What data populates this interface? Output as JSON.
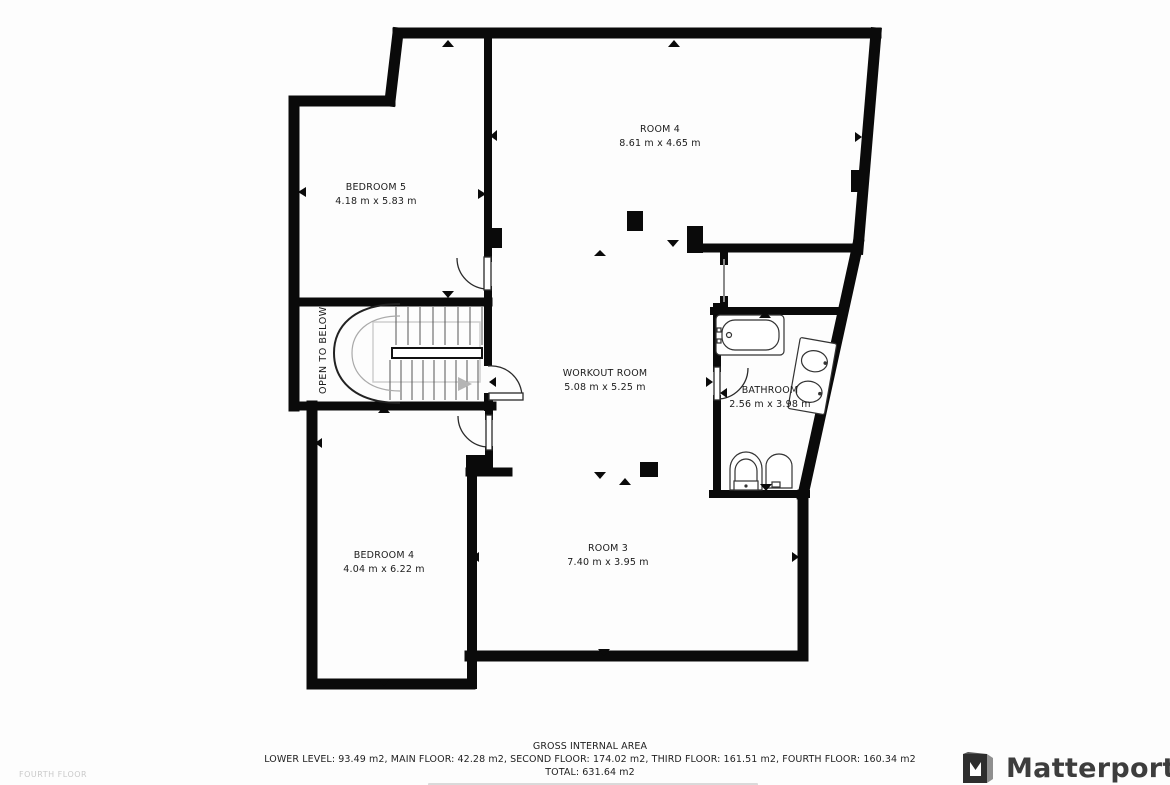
{
  "floor_label": "FOURTH FLOOR",
  "rooms": [
    {
      "id": "bedroom-5",
      "name": "BEDROOM 5",
      "dims": "4.18 m x 5.83 m"
    },
    {
      "id": "room-4",
      "name": "ROOM 4",
      "dims": "8.61 m x 4.65 m"
    },
    {
      "id": "workout-room",
      "name": "WORKOUT ROOM",
      "dims": "5.08 m x 5.25 m"
    },
    {
      "id": "bathroom",
      "name": "BATHROOM",
      "dims": "2.56 m x 3.98 m"
    },
    {
      "id": "bedroom-4",
      "name": "BEDROOM 4",
      "dims": "4.04 m x 6.22 m"
    },
    {
      "id": "room-3",
      "name": "ROOM 3",
      "dims": "7.40 m x 3.95 m"
    }
  ],
  "stairs": {
    "label": "OPEN TO BELOW"
  },
  "footer": {
    "title": "GROSS INTERNAL AREA",
    "breakdown": "LOWER LEVEL: 93.49 m2, MAIN FLOOR: 42.28 m2, SECOND FLOOR: 174.02 m2, THIRD FLOOR: 161.51 m2, FOURTH FLOOR: 160.34 m2",
    "total": "TOTAL: 631.64 m2"
  },
  "branding": {
    "logo_text": "Matterport"
  },
  "colors": {
    "wall": "#0a0a0a",
    "text": "#1c1c1c",
    "muted": "#c9c9c9",
    "logo": "#3d3d3d"
  }
}
